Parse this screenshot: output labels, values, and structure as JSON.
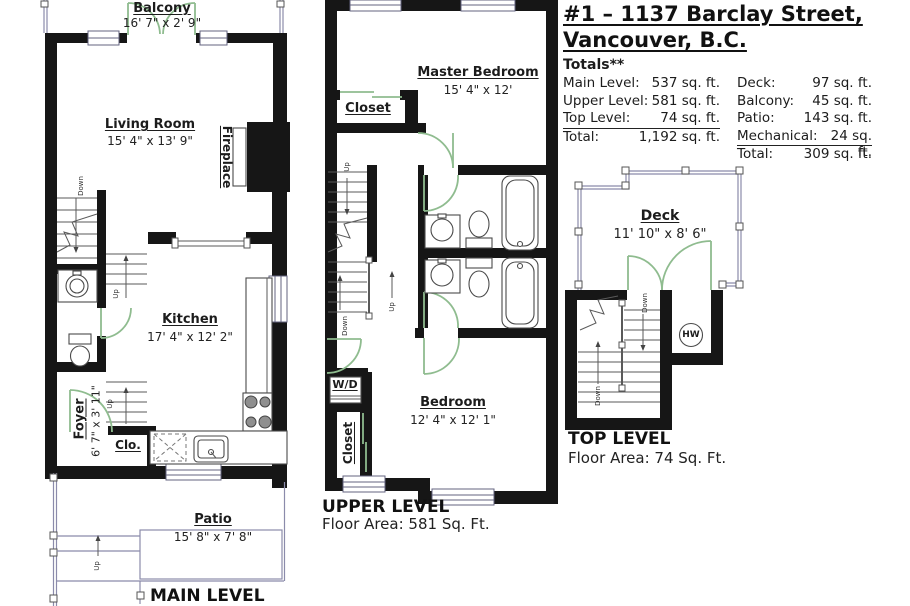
{
  "header": {
    "title_line1": "#1 – 1137 Barclay Street,",
    "title_line2": "Vancouver, B.C.",
    "totals_heading": "Totals**"
  },
  "totals": {
    "left": [
      {
        "label": "Main Level:",
        "value": "537 sq. ft."
      },
      {
        "label": "Upper Level:",
        "value": "581 sq. ft."
      },
      {
        "label": "Top Level:",
        "value": "74 sq. ft."
      },
      {
        "label": "Total:",
        "value": "1,192 sq. ft."
      }
    ],
    "right": [
      {
        "label": "Deck:",
        "value": "97 sq. ft."
      },
      {
        "label": "Balcony:",
        "value": "45 sq. ft."
      },
      {
        "label": "Patio:",
        "value": "143 sq. ft."
      },
      {
        "label": "Mechanical:",
        "value": "24 sq. ft."
      },
      {
        "label": "Total:",
        "value": "309 sq. ft."
      }
    ]
  },
  "main_level": {
    "caption": "MAIN LEVEL",
    "balcony": {
      "name": "Balcony",
      "dims": "16' 7\" x 2' 9\""
    },
    "living_room": {
      "name": "Living Room",
      "dims": "15' 4\" x 13' 9\""
    },
    "fireplace": "Fireplace",
    "kitchen": {
      "name": "Kitchen",
      "dims": "17' 4\" x 12' 2\""
    },
    "foyer": {
      "name": "Foyer",
      "dims": "6' 7\" x 3' 11\""
    },
    "closet": "Clo.",
    "patio": {
      "name": "Patio",
      "dims": "15' 8\" x 7' 8\""
    }
  },
  "upper_level": {
    "caption": "UPPER LEVEL",
    "floor_area": "Floor Area: 581 Sq. Ft.",
    "master_bedroom": {
      "name": "Master Bedroom",
      "dims": "15' 4\" x 12'"
    },
    "closet_master": "Closet",
    "washer_dryer": "W/D",
    "closet_lower": "Closet",
    "bedroom": {
      "name": "Bedroom",
      "dims": "12' 4\" x 12' 1\""
    }
  },
  "top_level": {
    "caption": "TOP LEVEL",
    "floor_area": "Floor Area: 74 Sq. Ft.",
    "deck": {
      "name": "Deck",
      "dims": "11' 10\" x 8' 6\""
    },
    "hot_water": "HW"
  },
  "stair_labels": {
    "up": "Up",
    "down": "Down"
  }
}
